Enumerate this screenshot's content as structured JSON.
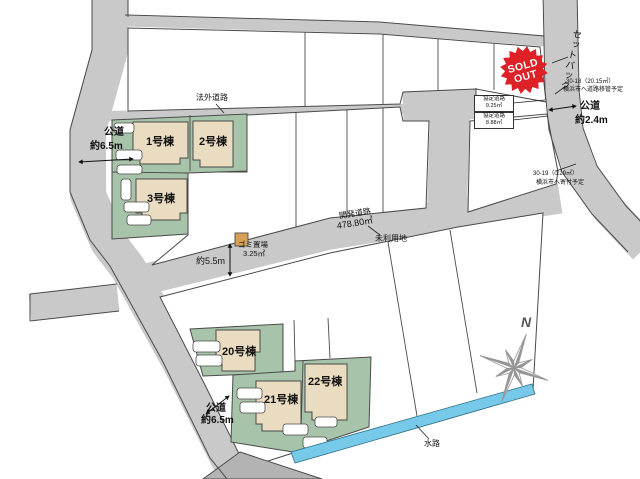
{
  "labels": {
    "hogai_road": "法外道路",
    "public_road_left": {
      "l1": "公道",
      "l2": "約6.5m"
    },
    "public_road_right": {
      "l1": "公道",
      "l2": "約2.4m"
    },
    "public_road_bottom": {
      "l1": "公道",
      "l2": "約6.5m"
    },
    "dev_road": {
      "l1": "開発道路",
      "l2": "478.80㎡"
    },
    "unused_land": "未利用地",
    "garbage": {
      "l1": "ゴミ置場",
      "l2": "3.25㎡"
    },
    "width_5_5m": "約5.5m",
    "kyotei_road_1": {
      "l1": "協定道路",
      "l2": "9.25㎡"
    },
    "kyotei_road_2": {
      "l1": "協定道路",
      "l2": "8.88㎡"
    },
    "setback": "セットバック",
    "lot_30_18": {
      "l1": "30-18（20.15㎡）",
      "l2": "横浜市へ道路移管予定"
    },
    "lot_30_19": {
      "l1": "30-19（0.29㎡）",
      "l2": "横浜市へ寄付予定"
    },
    "waterway": "水路",
    "compass_north": "N",
    "sold_out": {
      "l1": "SOLD",
      "l2": "OUT"
    }
  },
  "buildings": [
    {
      "label": "1号棟"
    },
    {
      "label": "2号棟"
    },
    {
      "label": "3号棟"
    },
    {
      "label": "20号棟"
    },
    {
      "label": "21号棟"
    },
    {
      "label": "22号棟"
    }
  ],
  "colors": {
    "road": "#c9c9c9",
    "road_dark": "#b3b3b3",
    "lot_green": "#a7c3aa",
    "building": "#eadcc1",
    "water": "#76c9e9",
    "stamp_red": "#dd2127",
    "compass_gray": "#969696",
    "line": "#4a4a4a",
    "car": "#ffffff",
    "garbage": "#d8a055"
  }
}
